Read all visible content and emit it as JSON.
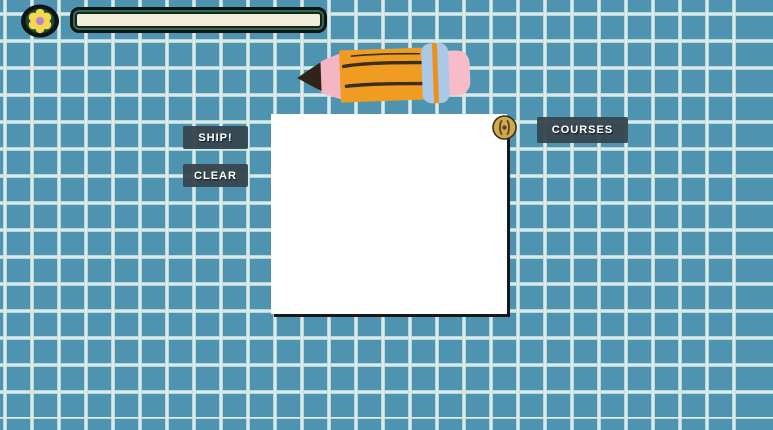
{
  "background": {
    "style": "graph-paper-grid",
    "cell_color": "#4e94b1",
    "grid_line_color": "#a5cdd2",
    "grid_bright_line_color": "#e0eeec",
    "cell_size_px": 27
  },
  "header": {
    "flower_icon": "flower-icon",
    "flower_colors": {
      "petals": "#f2d84b",
      "center": "#bc7fd2",
      "ring": "#1d4634",
      "outline": "#101418"
    },
    "progress_bar": {
      "value_percent": 0,
      "track_color": "#f1efdc",
      "frame_color": "#2e6b4f",
      "outline_color": "#101416"
    }
  },
  "buttons": {
    "ship": "SHIP!",
    "clear": "CLEAR",
    "courses": "COURSES",
    "bg_color": "#36444d",
    "text_color": "#ffffff"
  },
  "canvas": {
    "color": "#ffffff",
    "shadow_color": "#17181a",
    "pushpin_icon": "pushpin-icon",
    "pushpin_color": "#cfa94e"
  },
  "pencil": {
    "icon": "pencil-icon",
    "body_color": "#f09c22",
    "stripe_color": "#3a2e1c",
    "wood_color": "#f5b6c3",
    "tip_color": "#2f2417",
    "ferrule_color": "#a9c9e6",
    "ferrule_stripe_color": "#ef8f1e",
    "eraser_color": "#f8bcc8"
  }
}
